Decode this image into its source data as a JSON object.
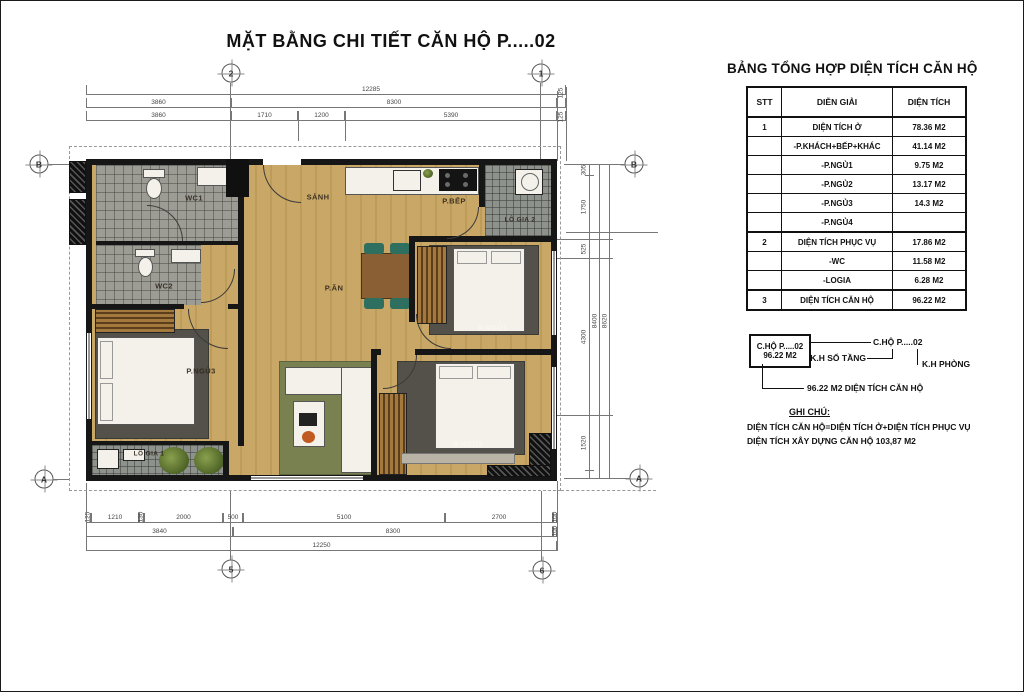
{
  "title": "MẶT BẰNG CHI TIẾT CĂN HỘ  P.....02",
  "area_table": {
    "title": "BẢNG TỔNG HỢP DIỆN TÍCH CĂN HỘ",
    "headers": [
      "STT",
      "DIỄN GIẢI",
      "DIỆN TÍCH"
    ],
    "rows": [
      {
        "stt": "1",
        "label": "DIỆN TÍCH Ở",
        "value": "78.36 M2"
      },
      {
        "stt": "",
        "label": "-P.KHÁCH+BẾP+KHÁC",
        "value": "41.14 M2"
      },
      {
        "stt": "",
        "label": "-P.NGỦ1",
        "value": "9.75 M2"
      },
      {
        "stt": "",
        "label": "-P.NGỦ2",
        "value": "13.17 M2"
      },
      {
        "stt": "",
        "label": "-P.NGỦ3",
        "value": "14.3 M2"
      },
      {
        "stt": "",
        "label": "-P.NGỦ4",
        "value": ""
      },
      {
        "stt": "2",
        "label": "DIỆN TÍCH PHỤC VỤ",
        "value": "17.86 M2"
      },
      {
        "stt": "",
        "label": "-WC",
        "value": "11.58 M2"
      },
      {
        "stt": "",
        "label": "-LOGIA",
        "value": "6.28 M2"
      },
      {
        "stt": "3",
        "label": "DIỆN TÍCH CĂN HỘ",
        "value": "96.22 M2"
      }
    ]
  },
  "legend": {
    "box_line1": "C.HỘ P.....02",
    "box_line2": "96.22 M2",
    "callout": "C.HỘ P.....02",
    "floor_code_label": "K.H SỐ TẦNG",
    "room_code_label": "K.H PHÒNG",
    "area_callout": "96.22 M2 DIỆN TÍCH CĂN HỘ",
    "notes_title": "GHI CHÚ:",
    "note1": "DIỆN TÍCH CĂN HỘ=DIỆN TÍCH Ở+DIỆN TÍCH PHỤC VỤ",
    "note2": "DIỆN TÍCH XÂY DỰNG CĂN HỘ 103,87 M2"
  },
  "rooms": {
    "wc1": "WC1",
    "wc2": "WC2",
    "hall": "SẢNH",
    "kitchen": "P.BẾP",
    "loggia2": "LÔ GIA 2",
    "dining": "P.ĂN",
    "bedroom1": "P.NGỦ1",
    "bedroom2": "P.NGỦ2",
    "bedroom3": "P.NGỦ3",
    "loggia1": "LÔ GIA 1"
  },
  "grid_bubbles": {
    "top_left": "2",
    "top_right": "1",
    "bottom_left": "5",
    "bottom_right": "6",
    "left_top": "B",
    "left_bottom": "A",
    "right_top": "B",
    "right_bottom": "A"
  },
  "dims": {
    "top_total": "12285",
    "top_row2": [
      "3860",
      "8300",
      "125"
    ],
    "top_row3": [
      "3860",
      "1710",
      "1200",
      "5390",
      "125"
    ],
    "bottom_row1": [
      "125",
      "1210",
      "130",
      "2000",
      "500",
      "5100",
      "2700",
      "100"
    ],
    "bottom_row2": [
      "3840",
      "8300",
      "100"
    ],
    "bottom_total": "12250",
    "right_chain": [
      "305",
      "1750",
      "525",
      "4300",
      "1520"
    ],
    "right_totals": [
      "8400",
      "8620"
    ]
  },
  "colors": {
    "wall": "#161616",
    "wood_floor": "#c9a766",
    "tile": "#9c9c95",
    "rug_green": "#78814f",
    "rug_dark": "#53514a",
    "chair_green": "#2f6f60"
  }
}
